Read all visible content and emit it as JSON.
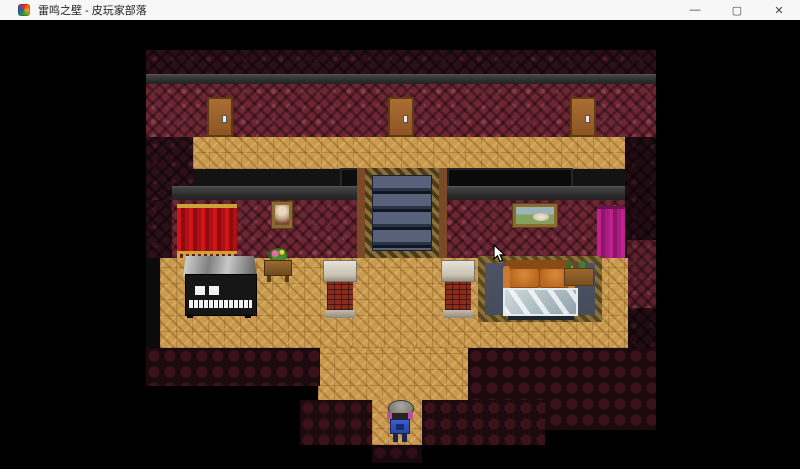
{
  "window": {
    "title": "雷鸣之壁 - 皮玩家部落",
    "icon": "game-app-icon",
    "controls": {
      "minimize": "—",
      "maximize": "▢",
      "close": "✕"
    }
  },
  "palette": {
    "titlebar_bg": "#f7f7f7",
    "background": "#000000",
    "wall_bright": "#6e2634",
    "wall_dim": "#2c1019",
    "ledge_gray": "#2f2f2f",
    "floor_wood": "#c89b4f",
    "floor_dark_tile": "#1d0a10",
    "door_wood": "#a0622d",
    "curtain_red": "#cc1318",
    "curtain_magenta": "#c0218f",
    "stairs_steps": "#57627a",
    "stairs_border_gold": "#8a7038",
    "sofa_leather": "#b5651d",
    "rug_slate": "#4c5364",
    "brick_red": "#8a2c1c",
    "piano_black": "#181818",
    "character_outfit_blue": "#3b5bd0"
  },
  "scene": {
    "objects": [
      "door-left",
      "door-middle",
      "door-right",
      "staircase",
      "red-curtain",
      "magenta-curtain",
      "portrait-painting",
      "landscape-painting",
      "piano",
      "flower-table",
      "brick-pillar-left",
      "brick-pillar-right",
      "rug",
      "sofa",
      "glass-table",
      "bottle-shelf",
      "doormat-tile",
      "player-character",
      "mouse-cursor"
    ]
  }
}
